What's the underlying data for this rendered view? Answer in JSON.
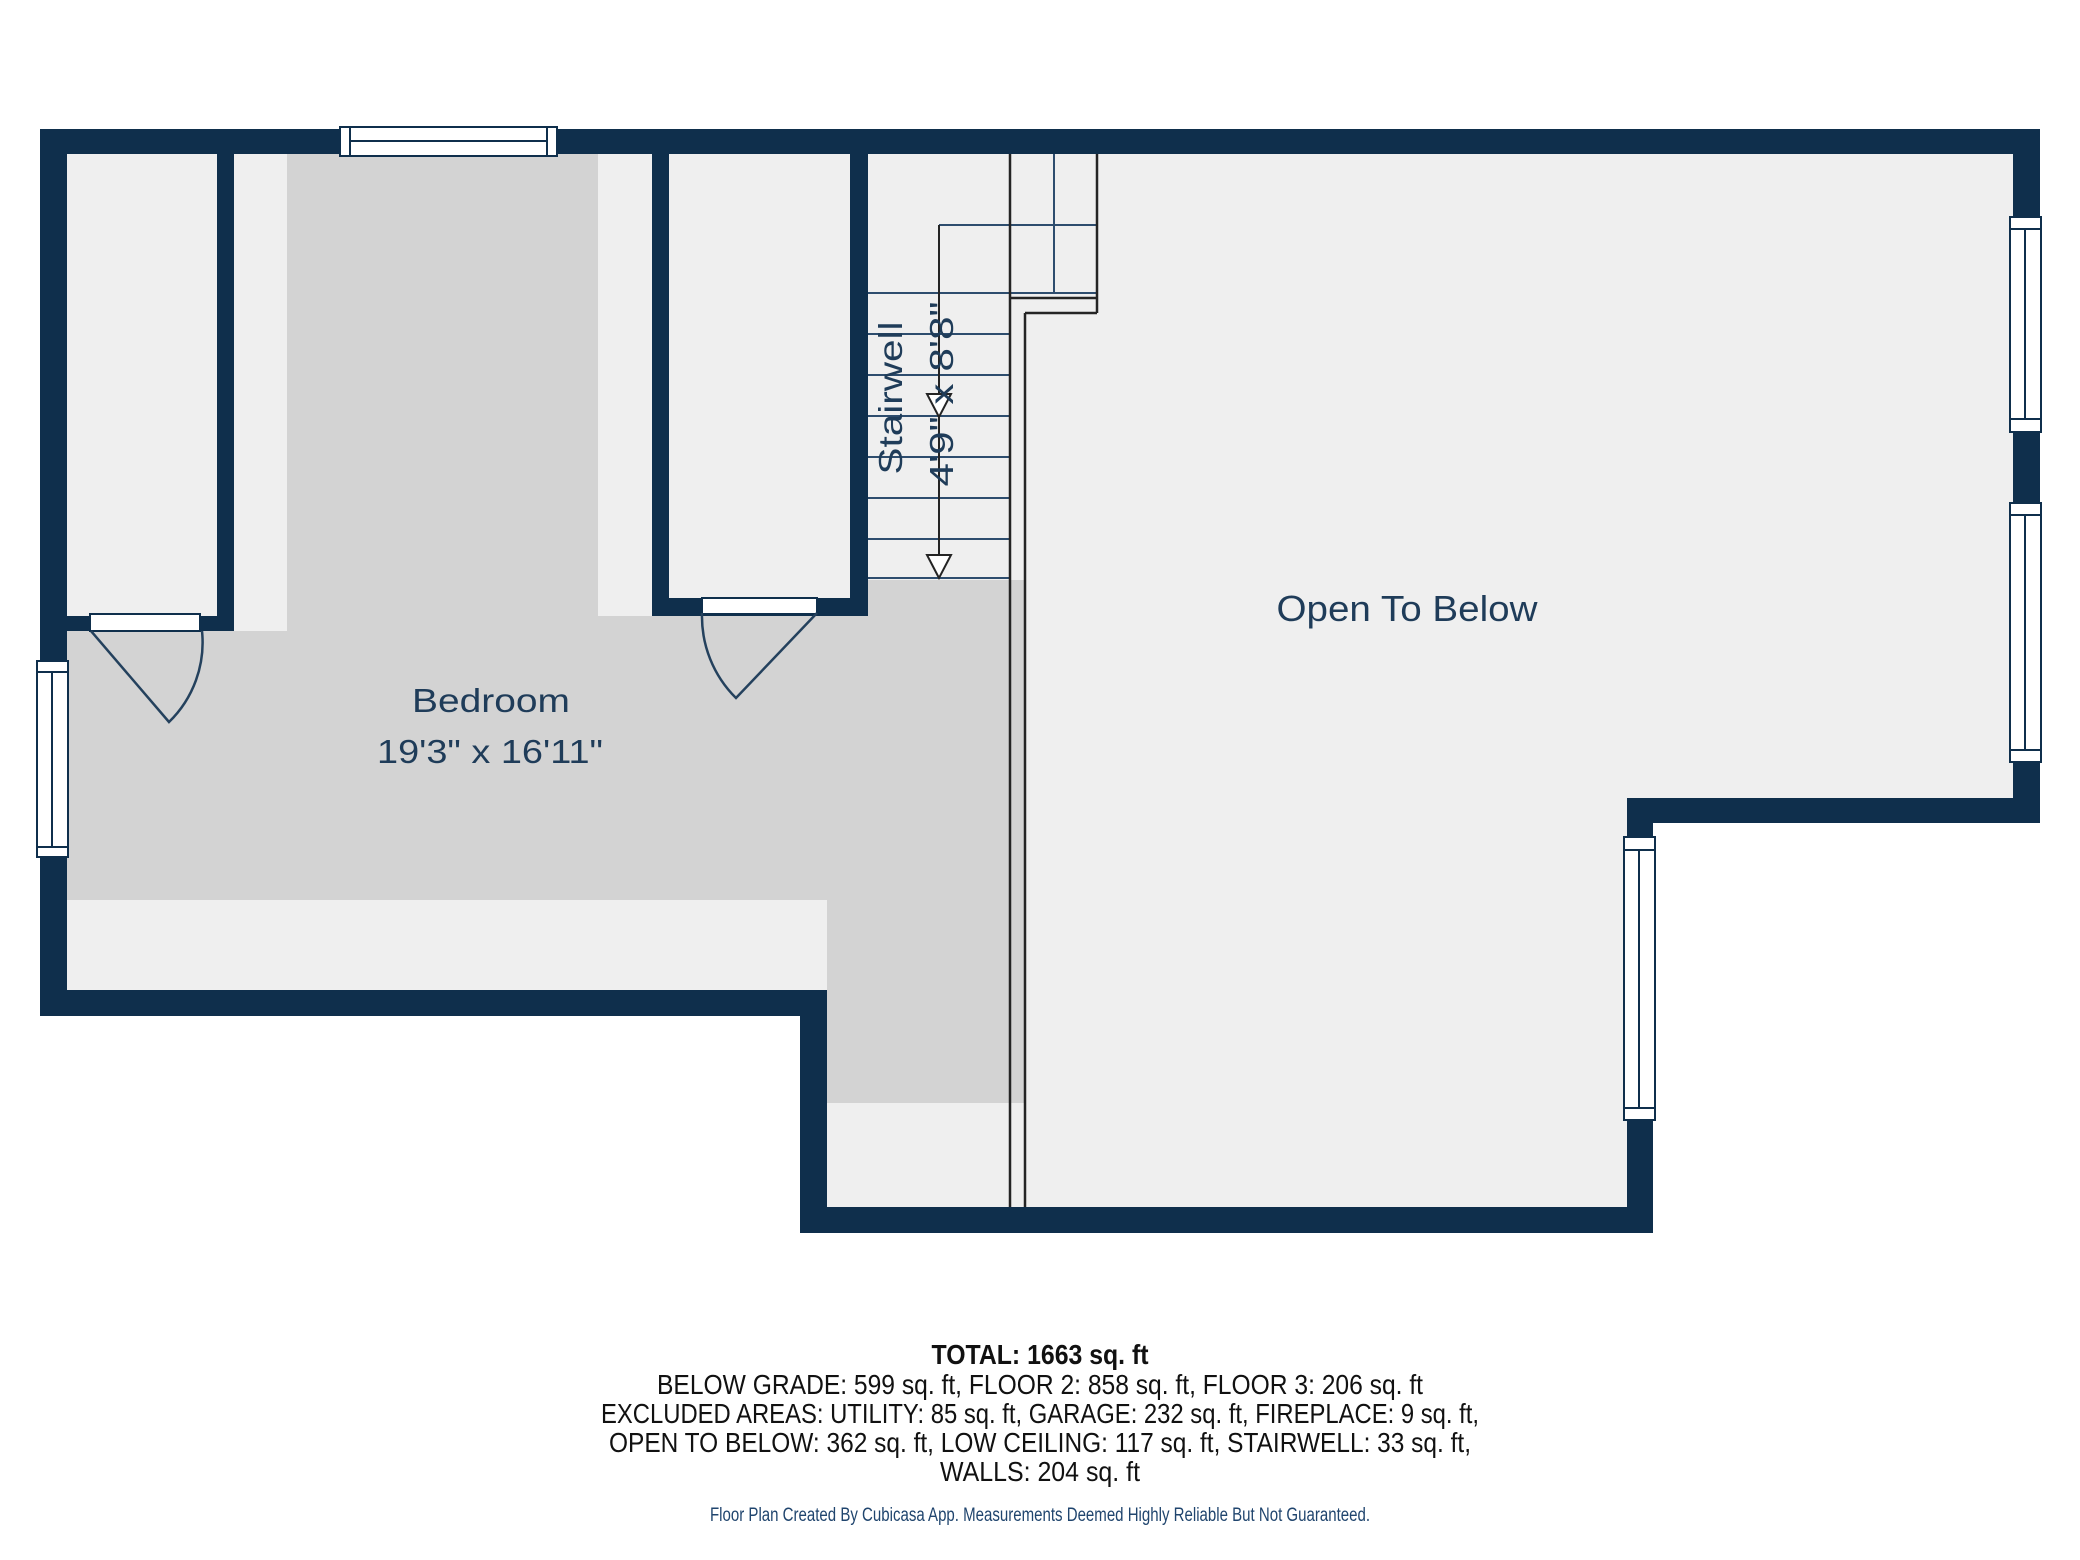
{
  "rooms": {
    "bedroom": {
      "label": "Bedroom",
      "dimensions": "19'3\" x 16'11\""
    },
    "stairwell": {
      "label": "Stairwell",
      "dimensions": "4'9\" x 8'8\""
    },
    "open_to_below": {
      "label": "Open To Below"
    }
  },
  "summary": {
    "total": "TOTAL: 1663 sq. ft",
    "floors": "BELOW GRADE: 599 sq. ft, FLOOR 2: 858 sq. ft, FLOOR 3: 206 sq. ft",
    "excluded_1": "EXCLUDED AREAS: UTILITY: 85 sq. ft, GARAGE: 232 sq. ft, FIREPLACE: 9 sq. ft,",
    "excluded_2": "OPEN TO BELOW: 362 sq. ft, LOW CEILING: 117 sq. ft, STAIRWELL: 33 sq. ft,",
    "walls": "WALLS: 204 sq. ft"
  },
  "footer": {
    "note": "Floor Plan Created By Cubicasa App. Measurements Deemed Highly Reliable But Not Guaranteed."
  },
  "colors": {
    "wall": "#0F2F4C",
    "floor_light": "#EFEFEF",
    "floor_room": "#D3D3D3",
    "label_text": "#1F3C59",
    "summary_text": "#111111",
    "footer_text": "#20456E",
    "railing": "#242424",
    "stair_line": "#2E4D6E"
  }
}
